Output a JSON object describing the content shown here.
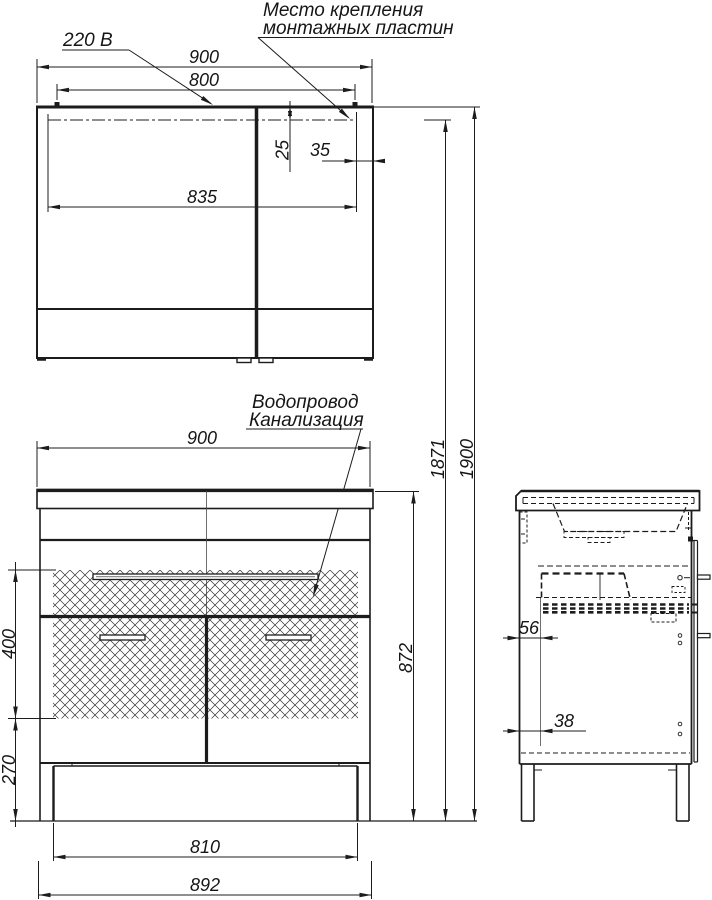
{
  "labels": {
    "power": "220 В",
    "mounting_line1": "Место крепления",
    "mounting_line2": "монтажных пластин",
    "plumbing_line1": "Водопровод",
    "plumbing_line2": "Канализация"
  },
  "mirror_cabinet": {
    "width": "900",
    "mount_spacing": "800",
    "mount_top_offset": "25",
    "mount_side_offset": "35",
    "inner_span": "835"
  },
  "vanity": {
    "width": "900",
    "hatch_zone_height": "400",
    "lower_zone_height": "270",
    "plinth_width": "810",
    "body_width": "892",
    "height": "872"
  },
  "overall": {
    "mount_height": "1871",
    "total_height": "1900"
  },
  "side_view": {
    "back_offset_upper": "56",
    "back_offset_lower": "38"
  }
}
